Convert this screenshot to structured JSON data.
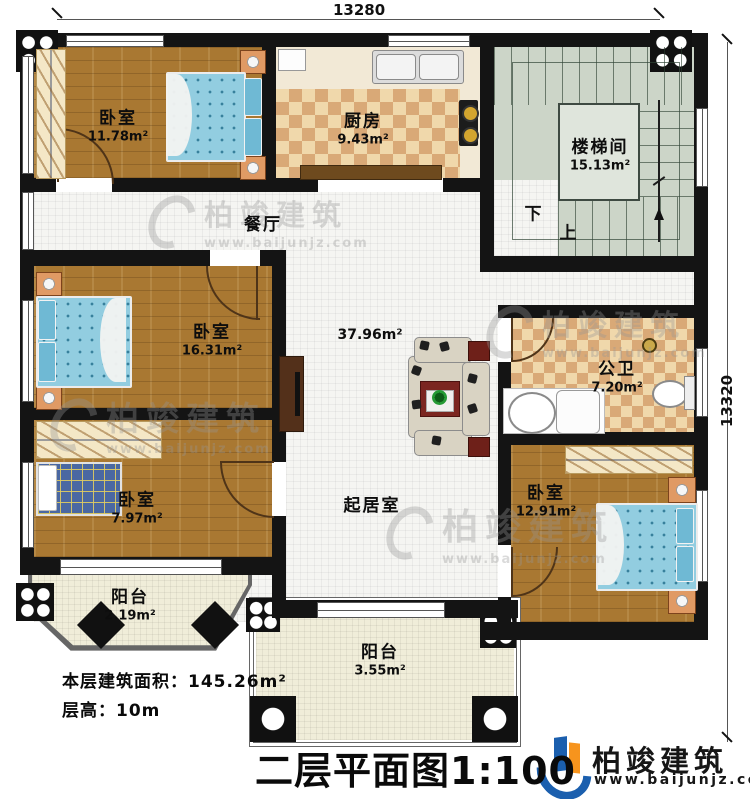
{
  "dimensions": {
    "top": "13280",
    "right": "13320"
  },
  "rooms": {
    "bedroom1": {
      "name": "卧室",
      "area": "11.78m²"
    },
    "kitchen": {
      "name": "厨房",
      "area": "9.43m²"
    },
    "stairwell": {
      "name": "楼梯间",
      "area": "15.13m²"
    },
    "dining": {
      "name": "餐厅"
    },
    "bedroom2": {
      "name": "卧室",
      "area": "16.31m²"
    },
    "bathroom": {
      "name": "公卫",
      "area": "7.20m²"
    },
    "bedroom3": {
      "name": "卧室",
      "area": "7.97m²"
    },
    "living": {
      "name": "起居室",
      "area": "37.96m²"
    },
    "bedroom4": {
      "name": "卧室",
      "area": "12.91m²"
    },
    "balcony1": {
      "name": "阳台",
      "area": "2.19m²"
    },
    "balcony2": {
      "name": "阳台",
      "area": "3.55m²"
    }
  },
  "stairs": {
    "down": "下",
    "up": "上"
  },
  "footer": {
    "floor_area_label": "本层建筑面积：",
    "floor_area_value": "145.26m²",
    "floor_height_label": "层高：",
    "floor_height_value": "10m",
    "title": "二层平面图1:100"
  },
  "brand": {
    "name": "柏竣建筑",
    "url": "www.baijunjz.com"
  },
  "watermark": {
    "name": "柏竣建筑",
    "url": "www.baijunjz.com"
  },
  "colors": {
    "wall": "#141414",
    "wood_floor": "#a97832",
    "checker_dark": "#d9a977",
    "checker_light": "#f0d8ab",
    "stair_floor": "#ccd5c8",
    "bed_blue": "#92cde0",
    "brand_blue": "#1b5fae",
    "brand_orange": "#f7941d"
  }
}
